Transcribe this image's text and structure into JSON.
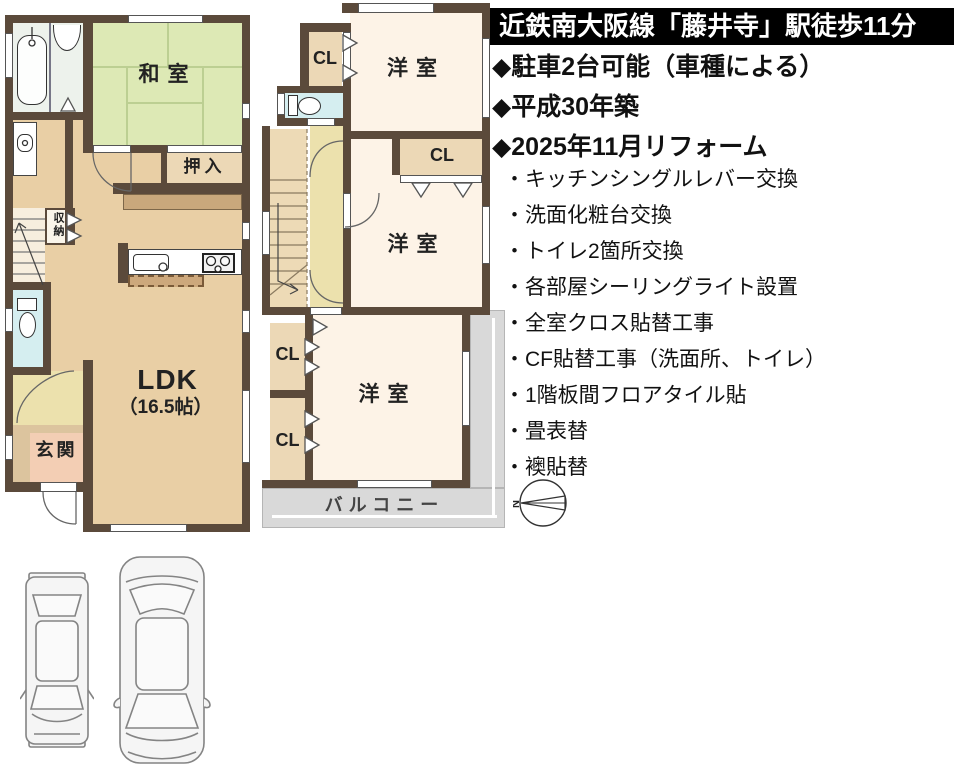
{
  "info_panel": {
    "header": "近鉄南大阪線「藤井寺」駅徒歩11分",
    "highlights": [
      "◆駐車2台可能（車種による）",
      "◆平成30年築",
      "◆2025年11月リフォーム"
    ],
    "renovations": [
      "・キッチンシングルレバー交換",
      "・洗面化粧台交換",
      "・トイレ2箇所交換",
      "・各部屋シーリングライト設置",
      "・全室クロス貼替工事",
      "・CF貼替工事（洗面所、トイレ）",
      "・1階板間フロアタイル貼",
      "・畳表替",
      "・襖貼替"
    ]
  },
  "floor_plan_1f": {
    "rooms": {
      "washitsu": "和室",
      "oshiire": "押入",
      "shunou": "収納",
      "ldk": "LDK",
      "ldk_size": "（16.5帖）",
      "genkan": "玄関"
    }
  },
  "floor_plan_2f": {
    "rooms": {
      "yoshitsu": "洋室",
      "closet": "CL",
      "balcony": "バルコニー"
    }
  },
  "compass": {
    "north": "N"
  },
  "colors": {
    "wall": "#5b4a3b",
    "tatami": "#dde9b5",
    "wood_floor": "#e9cfa5",
    "closet": "#ecd8b6",
    "hall": "#ece1ad",
    "toilet": "#d5eef0",
    "bathroom": "#edf2ec",
    "genkan": "#f3ceb4",
    "western_room": "#fdf3e7",
    "balcony": "#d9d9d9",
    "header_bg": "#000000",
    "header_text": "#ffffff"
  }
}
